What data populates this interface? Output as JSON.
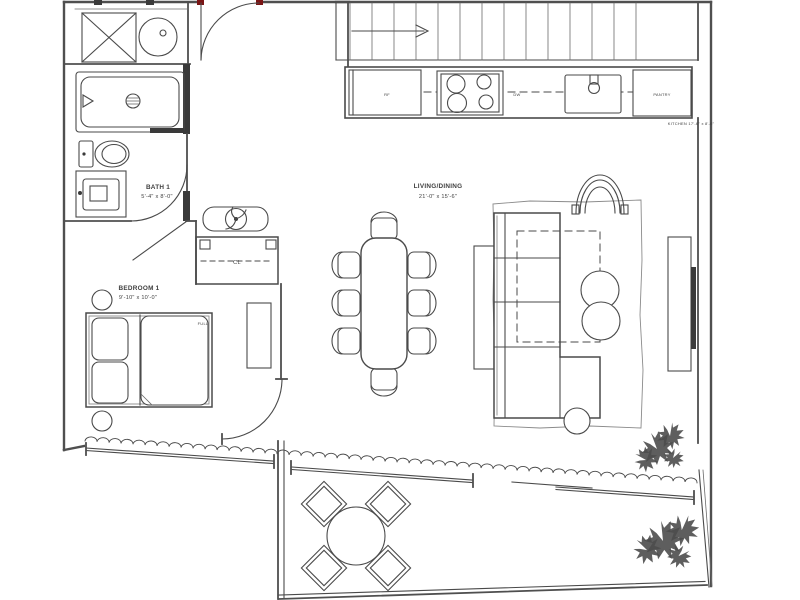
{
  "page": {
    "background": "#ffffff",
    "type": "architectural-floor-plan"
  },
  "colors": {
    "line": "#4a4a4a",
    "wall": "#4f4f4f",
    "door_accent": "#7a1414",
    "text": "#3f3f3f",
    "poche": "#3a3a3a"
  },
  "labels": {
    "bath": {
      "name": "BATH 1",
      "dims": "5'-4\" x 8'-0\""
    },
    "bedroom": {
      "name": "BEDROOM 1",
      "dims": "9'-10\" x 10'-0\""
    },
    "living_dining": {
      "name": "LIVING/DINING",
      "dims": "21'-0\" x 15'-6\""
    },
    "closet": {
      "name": "CL"
    },
    "bed_size": "FULL",
    "kitchen_note": "KITCHEN 17'-6\" x 8'-6\"",
    "refrigerator": "RF",
    "dishwasher": "DW",
    "pantry": "PANTRY"
  },
  "icons": {
    "stairs_direction": "arrow-right-icon",
    "washer": "x-box-washer-icon",
    "dryer": "circle-dryer-icon",
    "plants": "palm-plant-icon",
    "cooktop": "four-burner-icon",
    "ceiling_fan": "fan-icon"
  }
}
